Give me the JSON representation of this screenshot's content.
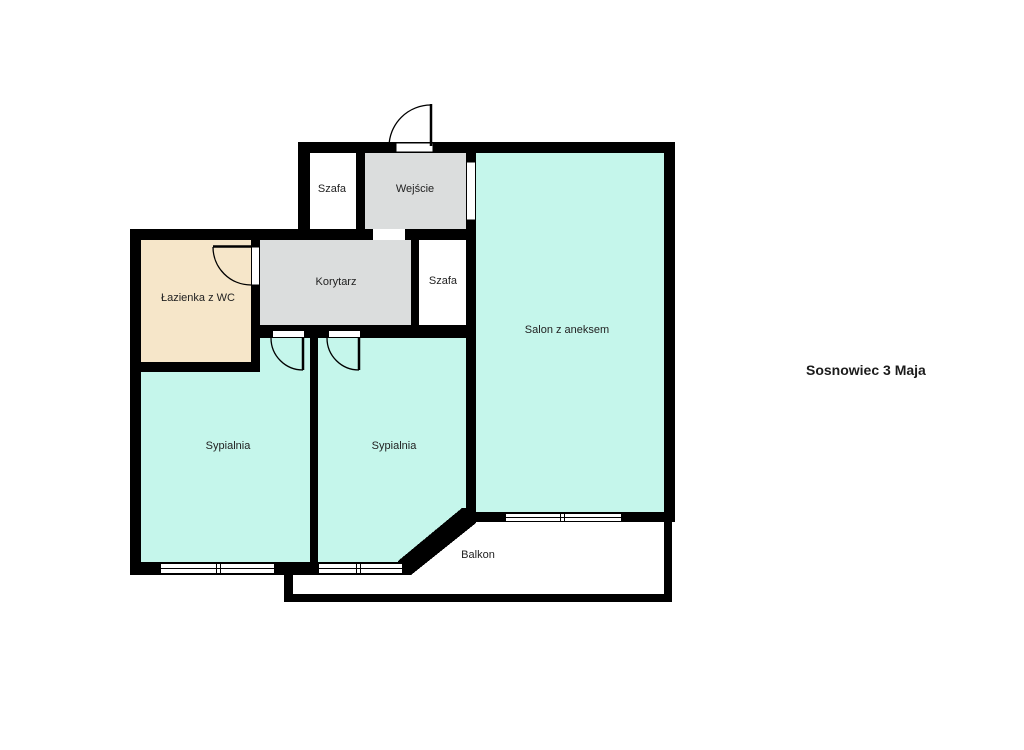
{
  "title": "Sosnowiec 3 Maja",
  "floorplan": {
    "wall_color": "#000000",
    "label_color": "#222222",
    "rooms": [
      {
        "id": "szafa-gora",
        "label": "Szafa",
        "color": "#ffffff"
      },
      {
        "id": "wejscie",
        "label": "Wejście",
        "color": "#dbdddd"
      },
      {
        "id": "salon",
        "label": "Salon z aneksem",
        "color": "#c5f6eb"
      },
      {
        "id": "korytarz",
        "label": "Korytarz",
        "color": "#dbdddd"
      },
      {
        "id": "szafa-prawa",
        "label": "Szafa",
        "color": "#ffffff"
      },
      {
        "id": "lazienka",
        "label": "Łazienka z WC",
        "color": "#f6e6c9"
      },
      {
        "id": "sypialnia-lewa",
        "label": "Sypialnia",
        "color": "#c5f6eb"
      },
      {
        "id": "sypialnia-srodkowa",
        "label": "Sypialnia",
        "color": "#c5f6eb"
      },
      {
        "id": "balkon",
        "label": "Balkon",
        "color": "#ffffff"
      }
    ]
  }
}
